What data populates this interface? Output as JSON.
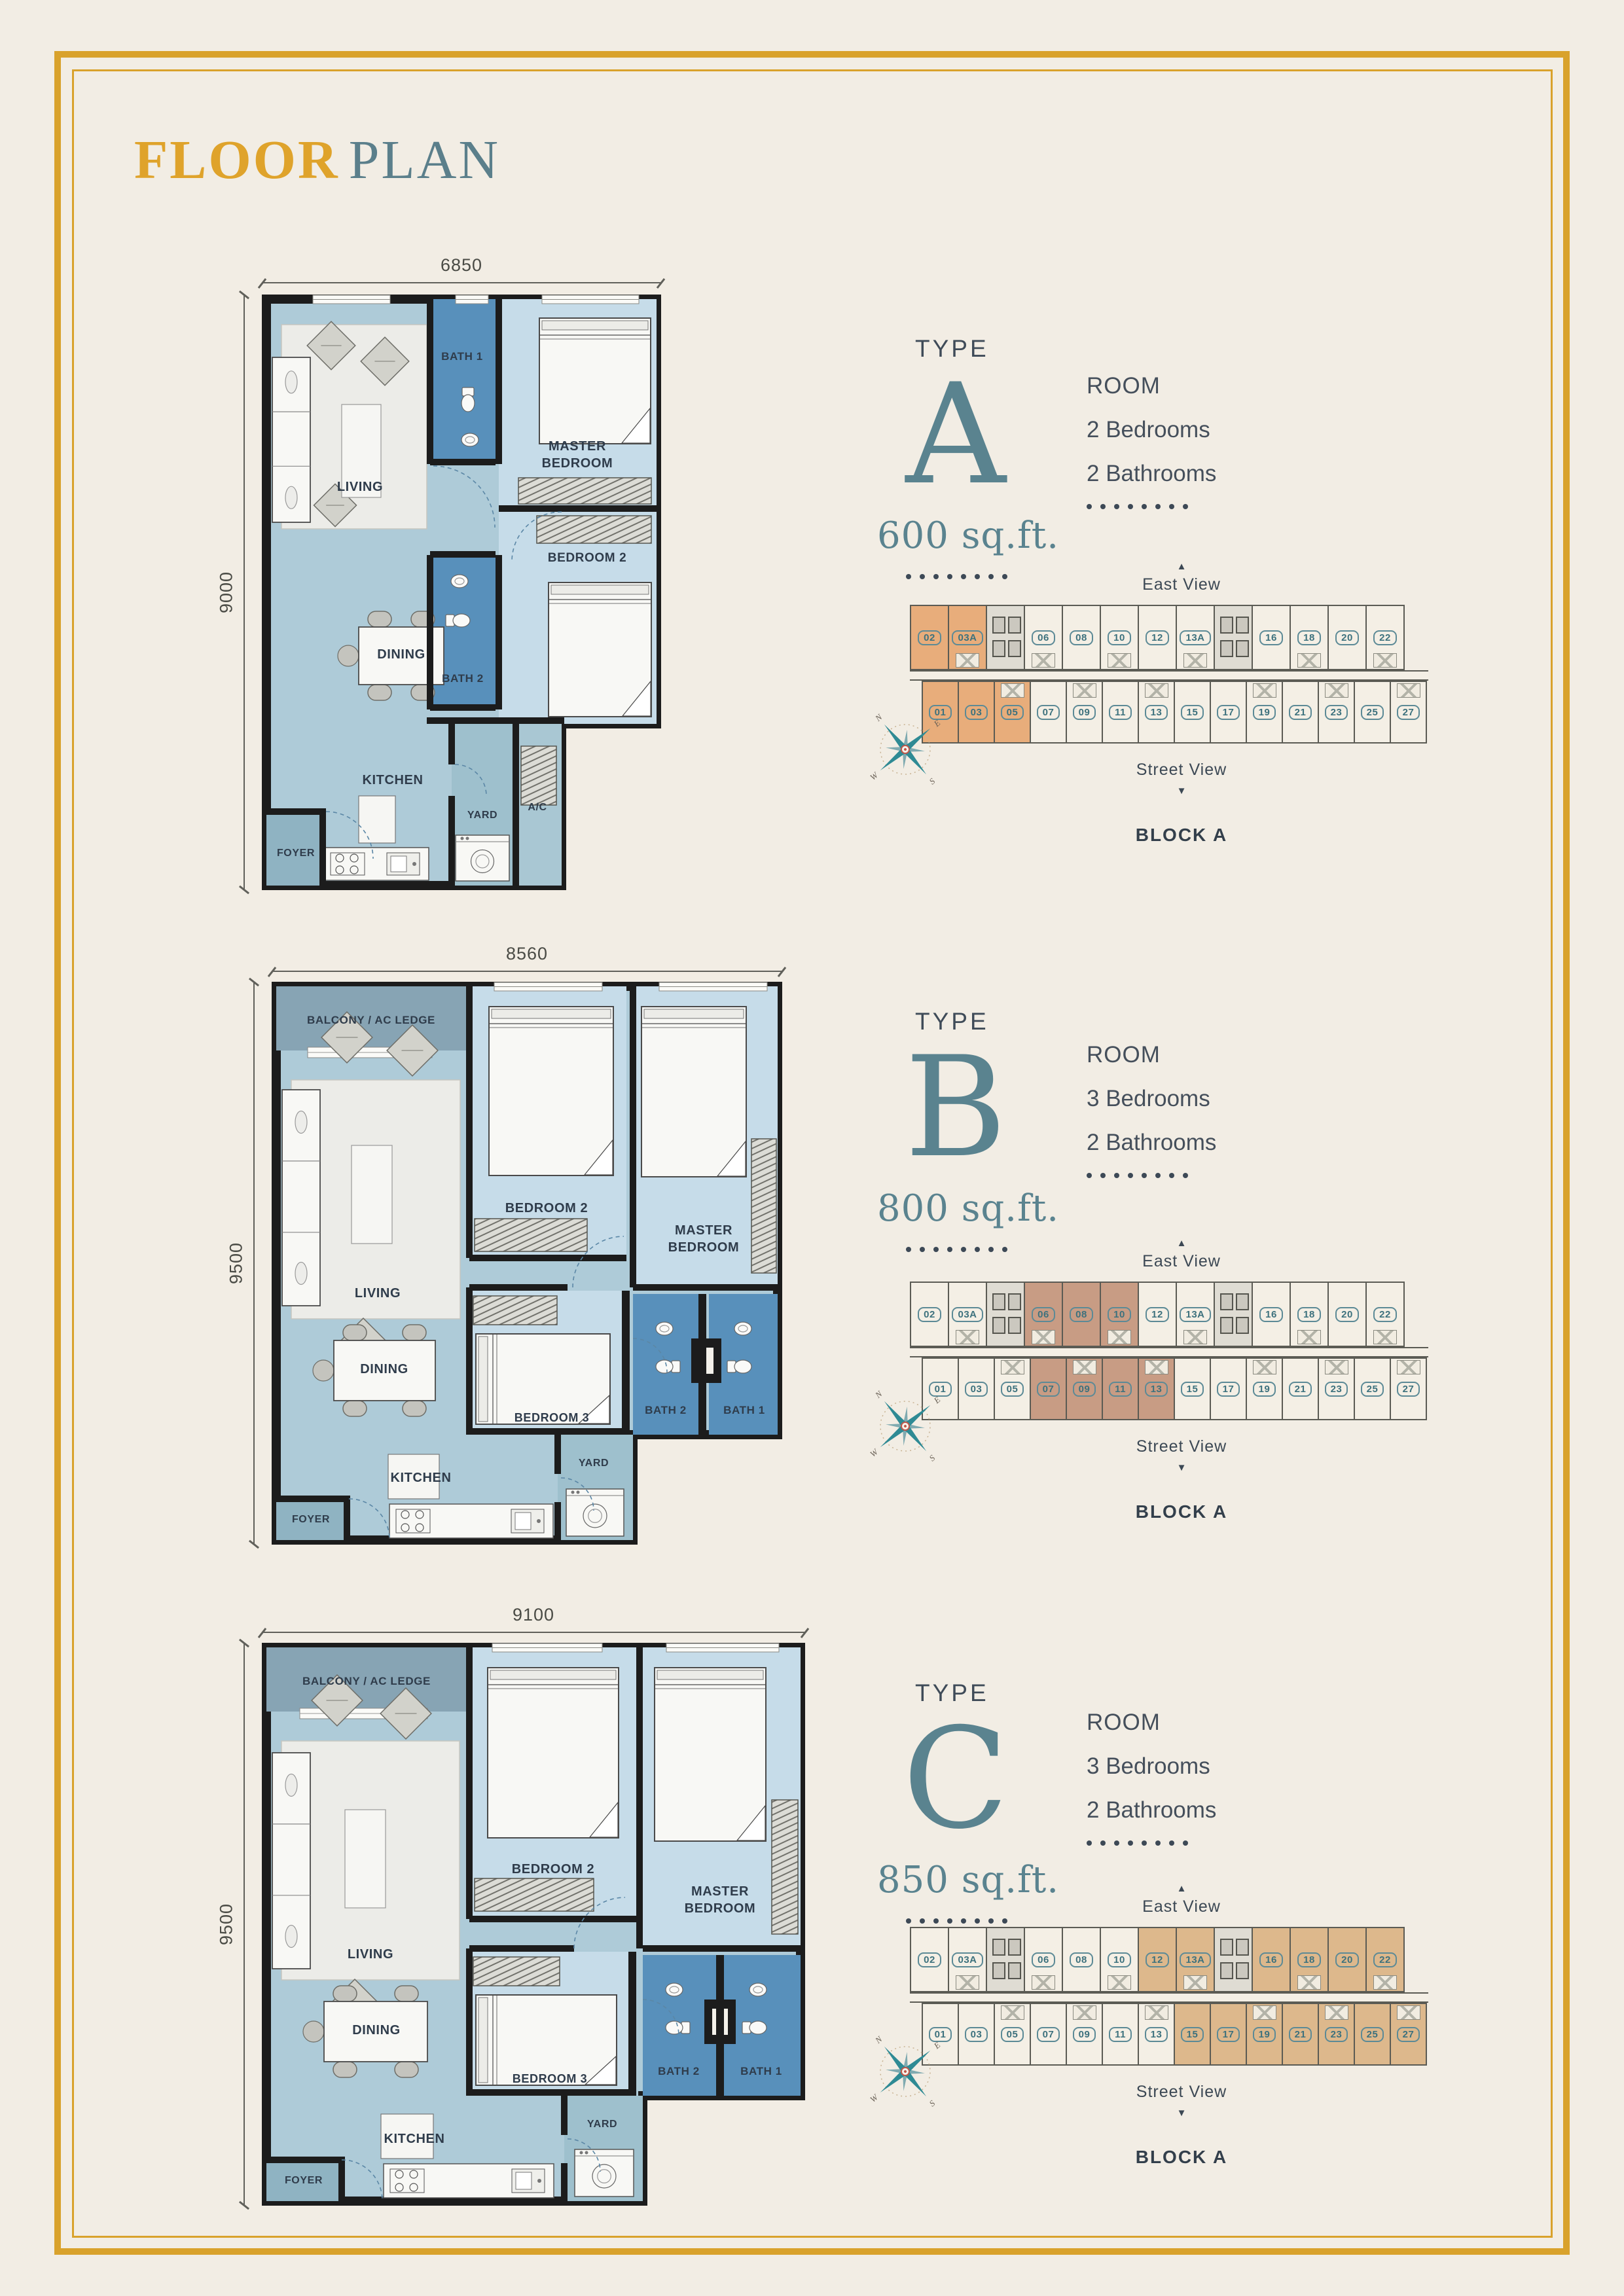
{
  "page": {
    "title": {
      "primary": "FLOOR",
      "secondary": "PLAN"
    }
  },
  "shared": {
    "type_label": "TYPE",
    "room_header": "ROOM",
    "east_view": "East View",
    "street_view": "Street View",
    "block_label": "BLOCK A",
    "compass": {
      "north": "N",
      "east": "E",
      "south": "S",
      "west": "W"
    },
    "block": {
      "top_units": [
        "02",
        "03A",
        null,
        "06",
        "08",
        "10",
        "12",
        "13A",
        null,
        "16",
        "18",
        "20",
        "22"
      ],
      "bottom_units": [
        "01",
        "03",
        "05",
        "07",
        "09",
        "11",
        "13",
        "15",
        "17",
        "19",
        "21",
        "23",
        "25",
        "27"
      ]
    }
  },
  "colors": {
    "gold": "#D9A22C",
    "teal": "#5A838F",
    "slate": "#3D4956",
    "wall": "#1C1C1C",
    "bath_blue": "#5890BB",
    "bedroom_blue": "#C6DCE9",
    "floor_blue": "#AECBD8",
    "highlight_type_a": "#E8AD7B",
    "highlight_type_b": "#C89C84",
    "highlight_type_c": "#DDB88C"
  },
  "types": [
    {
      "letter": "A",
      "area": "600 sq.ft.",
      "bedrooms": "2 Bedrooms",
      "bathrooms": "2 Bathrooms",
      "width_dim": "6850",
      "height_dim": "9000",
      "rooms": {
        "living": "LIVING",
        "bath1": "BATH 1",
        "master": "MASTER BEDROOM",
        "bedroom2": "BEDROOM 2",
        "dining": "DINING",
        "bath2": "BATH 2",
        "kitchen": "KITCHEN",
        "yard": "YARD",
        "ac": "A/C",
        "foyer": "FOYER"
      },
      "block": {
        "highlighted": [
          "02",
          "03A",
          "01",
          "03",
          "05"
        ],
        "highlight_color": "#E8AD7B"
      }
    },
    {
      "letter": "B",
      "area": "800 sq.ft.",
      "bedrooms": "3 Bedrooms",
      "bathrooms": "2 Bathrooms",
      "width_dim": "8560",
      "height_dim": "9500",
      "rooms": {
        "balcony": "BALCONY / AC LEDGE",
        "living": "LIVING",
        "bedroom2": "BEDROOM 2",
        "master": "MASTER BEDROOM",
        "dining": "DINING",
        "bedroom3": "BEDROOM 3",
        "bath2": "BATH 2",
        "bath1": "BATH 1",
        "yard": "YARD",
        "kitchen": "KITCHEN",
        "foyer": "FOYER"
      },
      "block": {
        "highlighted": [
          "06",
          "08",
          "10",
          "07",
          "09",
          "11",
          "13"
        ],
        "highlight_color": "#C89C84"
      }
    },
    {
      "letter": "C",
      "area": "850 sq.ft.",
      "bedrooms": "3 Bedrooms",
      "bathrooms": "2 Bathrooms",
      "width_dim": "9100",
      "height_dim": "9500",
      "rooms": {
        "balcony": "BALCONY / AC LEDGE",
        "living": "LIVING",
        "bedroom2": "BEDROOM 2",
        "master": "MASTER BEDROOM",
        "dining": "DINING",
        "bedroom3": "BEDROOM 3",
        "bath2": "BATH 2",
        "bath1": "BATH 1",
        "yard": "YARD",
        "kitchen": "KITCHEN",
        "foyer": "FOYER"
      },
      "block": {
        "highlighted": [
          "12",
          "13A",
          "16",
          "18",
          "20",
          "22",
          "15",
          "17",
          "19",
          "21",
          "23",
          "25",
          "27"
        ],
        "highlight_color": "#DDB88C"
      }
    }
  ]
}
